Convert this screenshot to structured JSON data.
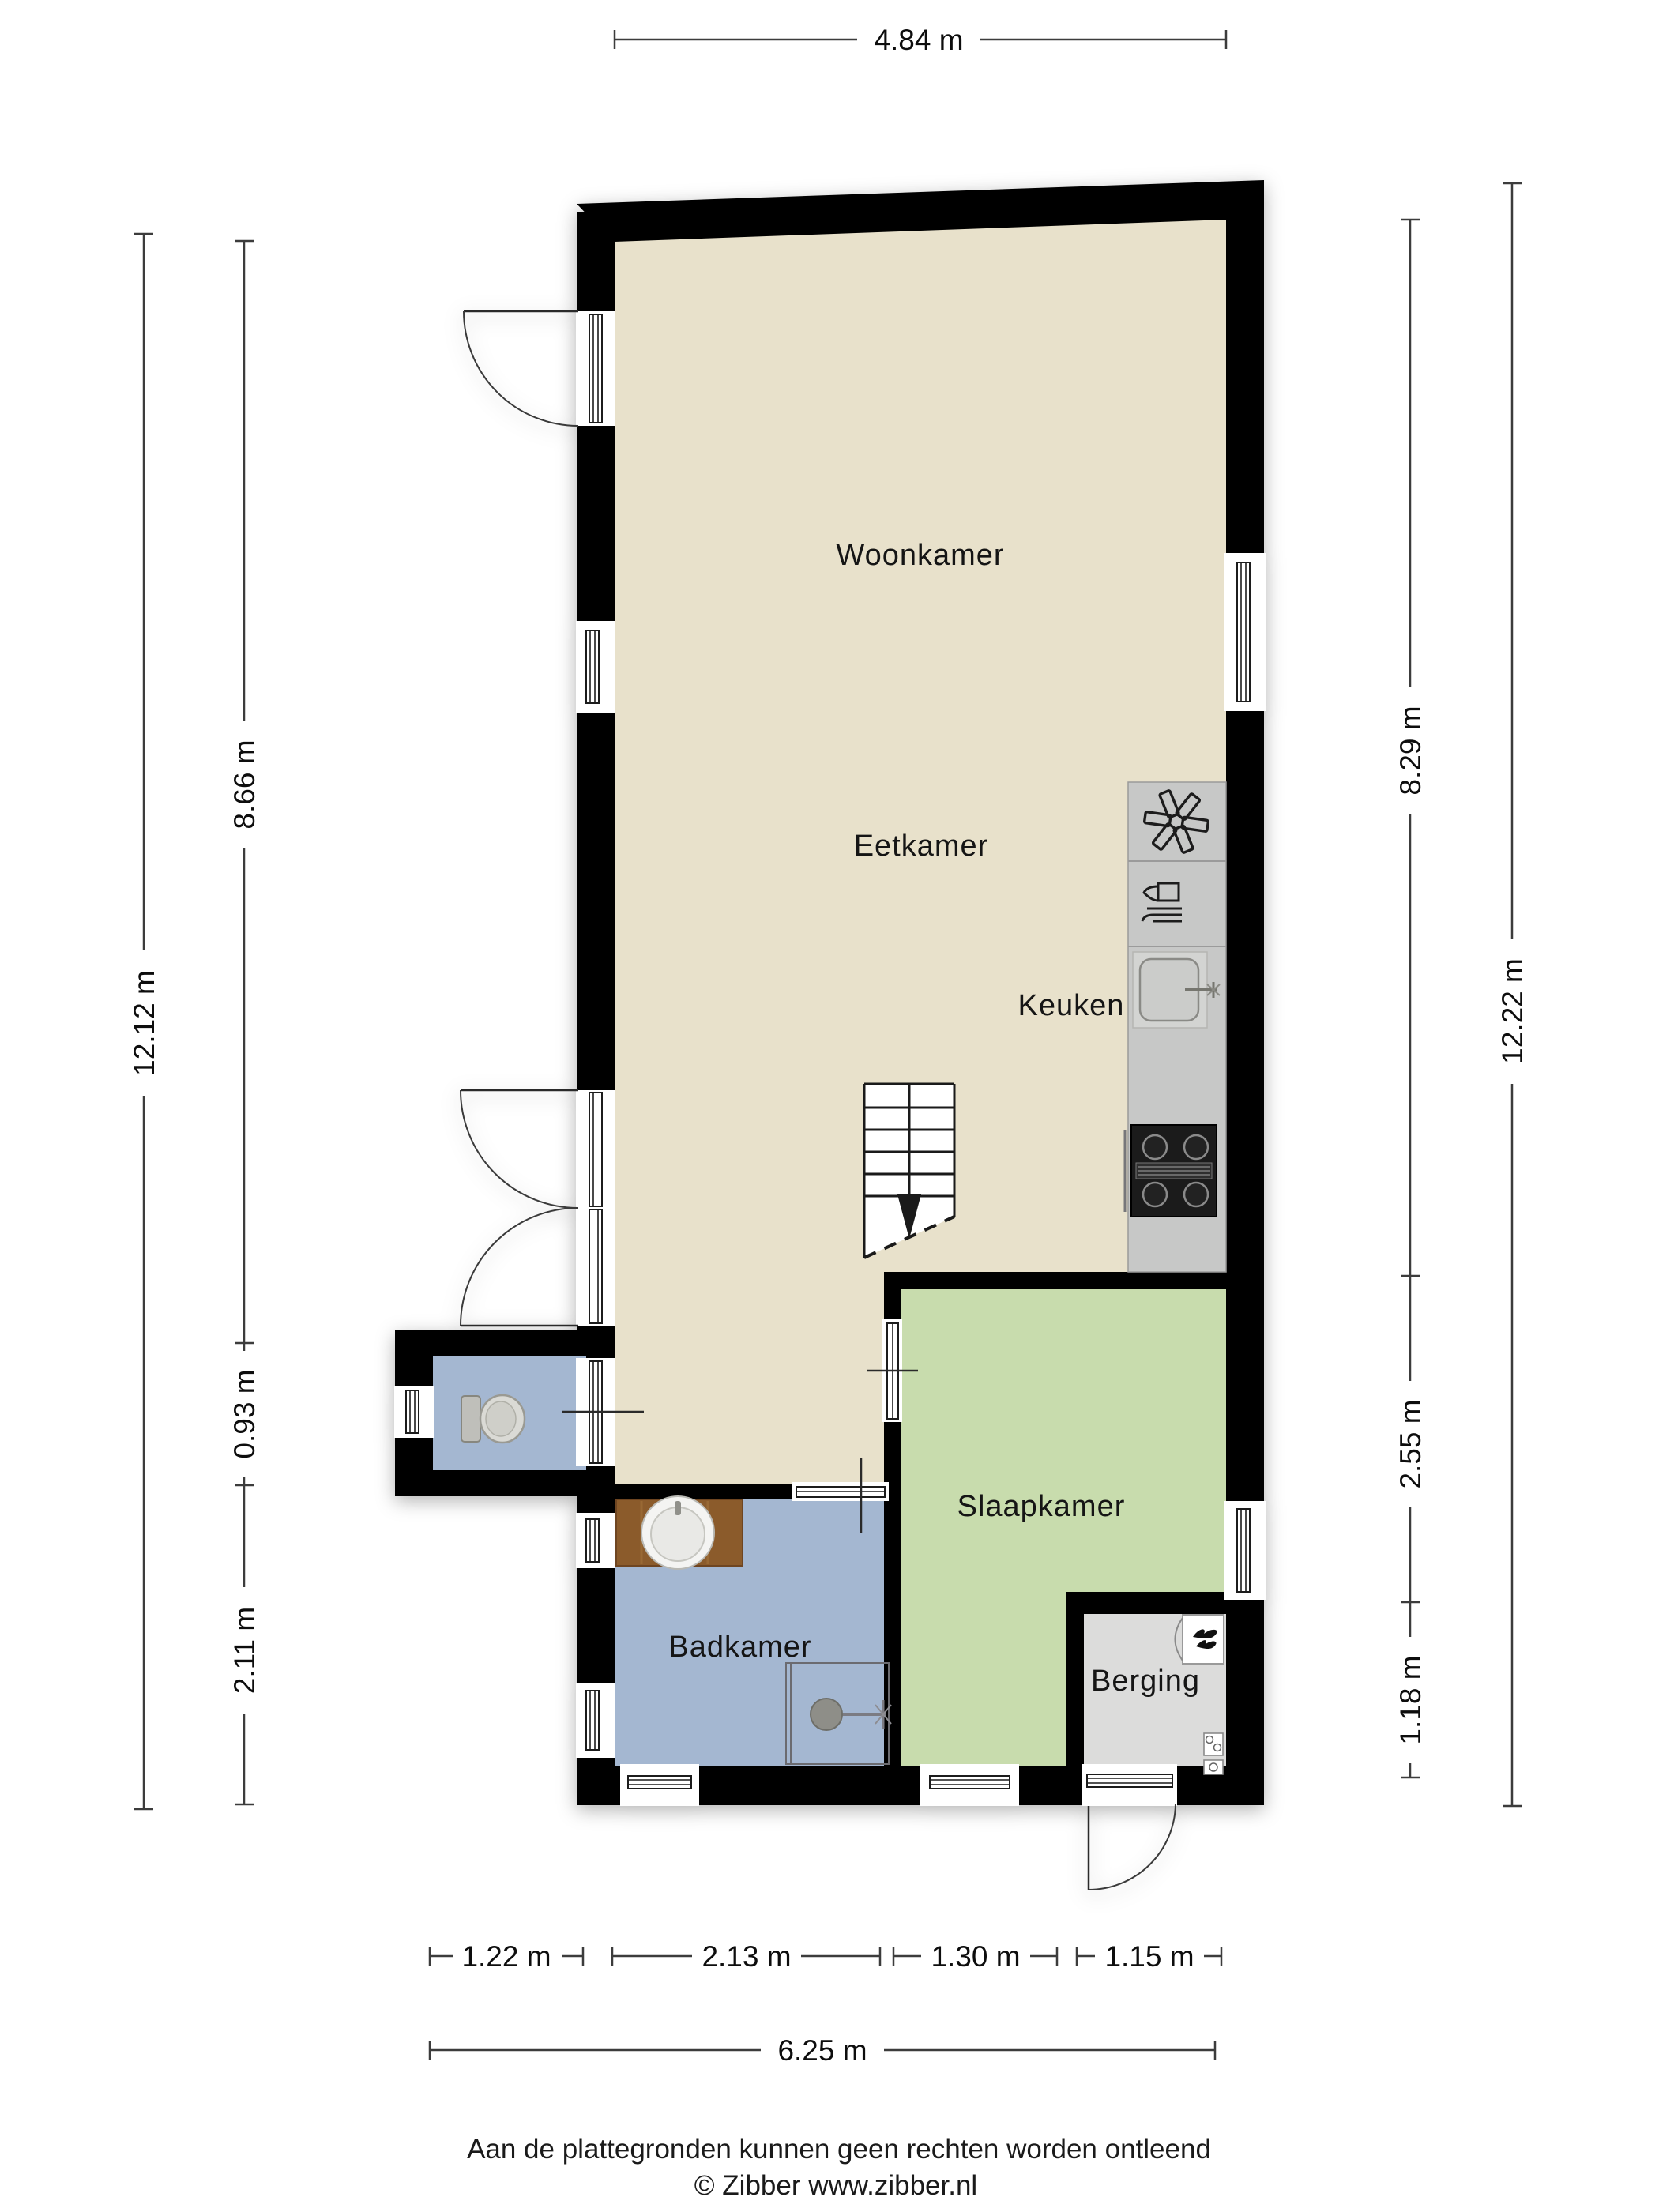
{
  "floorplan": {
    "rooms": {
      "woonkamer": "Woonkamer",
      "eetkamer": "Eetkamer",
      "keuken": "Keuken",
      "slaapkamer": "Slaapkamer",
      "badkamer": "Badkamer",
      "berging": "Berging"
    },
    "dimensions": {
      "top": "4.84 m",
      "left": {
        "total": "12.12 m",
        "upper": "8.66 m",
        "middle": "0.93 m",
        "lower": "2.11 m"
      },
      "right": {
        "upper": "8.29 m",
        "middle": "2.55 m",
        "lower": "1.18 m",
        "total": "12.22 m"
      },
      "bottom": {
        "seg1": "1.22 m",
        "seg2": "2.13 m",
        "seg3": "1.30 m",
        "seg4": "1.15 m",
        "total": "6.25 m"
      }
    },
    "footer": {
      "disclaimer": "Aan de plattegronden kunnen geen rechten worden ontleend",
      "copyright": "© Zibber www.zibber.nl"
    },
    "colors": {
      "wall": "#000000",
      "living": "#E8E1CB",
      "wet": "#A4B7D1",
      "bedroom": "#C8DCAD",
      "storage": "#DCDCDB",
      "counter": "#C7C8C7",
      "wood": "#8B5B2B"
    },
    "icons": {
      "stairs": "stairs-icon",
      "freezer": "freezer-asterisk-icon",
      "dishwasher": "dishwasher-icon",
      "kitchen_sink": "kitchen-sink-icon",
      "stove": "stove-icon",
      "toilet": "toilet-icon",
      "washbasin": "washbasin-icon",
      "shower": "shower-icon",
      "boiler": "boiler-flame-icon",
      "meter": "meter-icon"
    }
  }
}
